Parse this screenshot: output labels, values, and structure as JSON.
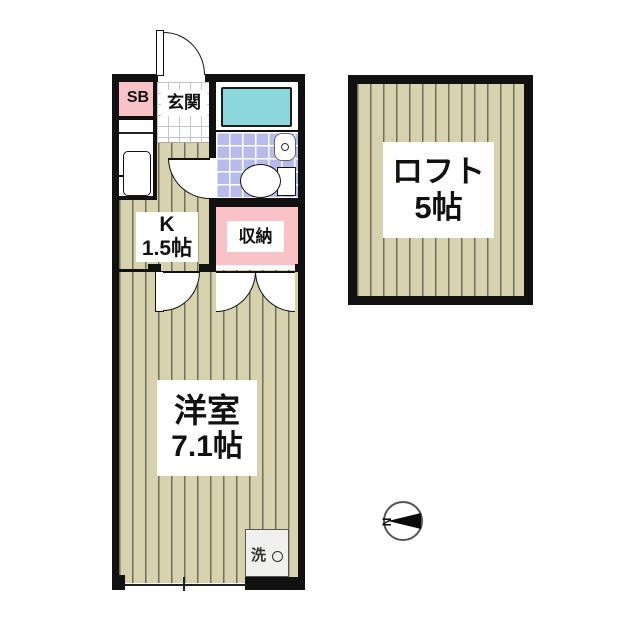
{
  "rooms": {
    "entrance": {
      "label": "玄関"
    },
    "shoe_box": {
      "label": "SB"
    },
    "kitchen": {
      "label": "K",
      "size": "1.5帖"
    },
    "storage": {
      "label": "収納"
    },
    "western_room": {
      "label": "洋室",
      "size": "7.1帖"
    },
    "loft": {
      "label": "ロフト",
      "size": "5帖"
    },
    "washer": {
      "label": "洗"
    }
  },
  "compass": {
    "north_label": "N"
  },
  "colors": {
    "wall": "#111111",
    "floor_base": "#d6d2ae",
    "floor_stripe": "#6f6f5a",
    "accent_pink": "#f9c2c7",
    "bathtub_cyan": "#8bd7db",
    "bath_tile_lavender": "#b7baec"
  }
}
